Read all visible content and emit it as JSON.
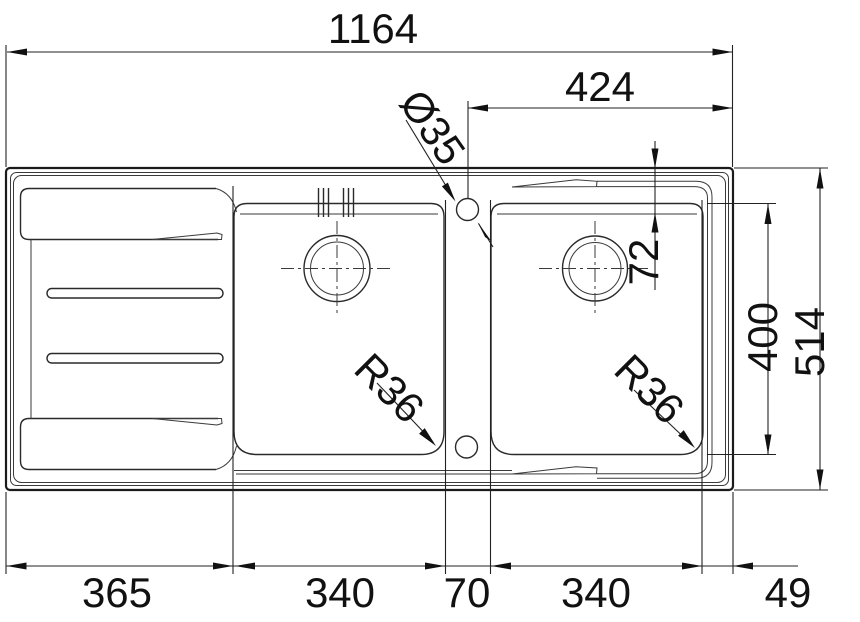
{
  "drawing": {
    "type": "sink-plan-technical-drawing",
    "line_color": "#1b1b1b",
    "background": "#ffffff"
  },
  "annotations": {
    "overall_length": "1164",
    "tap_hole_to_right_edge": "424",
    "tap_hole_diameter": "Ø35",
    "rim_to_bowl_offset": "72",
    "bowl_front_to_back": "400",
    "overall_depth": "514",
    "corner_radius_left_bowl": "R36",
    "corner_radius_right_bowl": "R36",
    "bottom_segments": [
      "365",
      "340",
      "70",
      "340",
      "49"
    ]
  }
}
